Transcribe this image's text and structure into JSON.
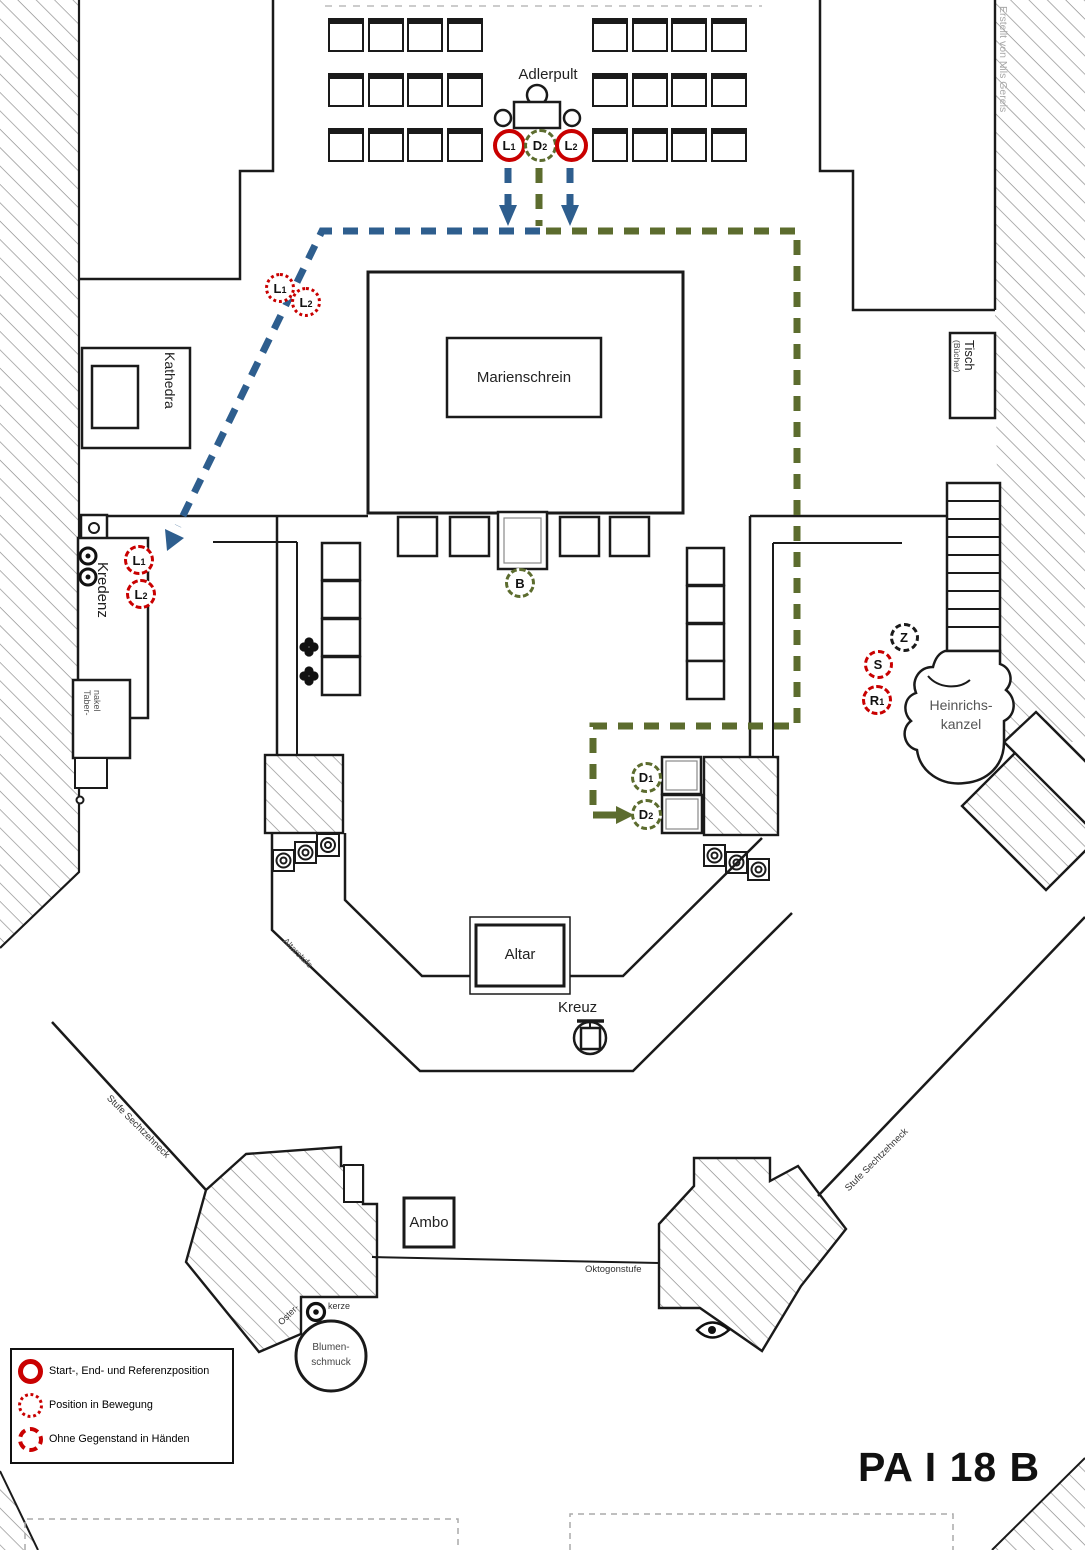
{
  "plan": {
    "code": "PA I 18 B",
    "credit": "Erstellt von Nils Gereis"
  },
  "colors": {
    "path_blue": "#2e5e8e",
    "path_green": "#5c6c2e",
    "marker_red": "#c90000",
    "marker_black": "#1a1a1a",
    "hatch_gray": "#8f8f8f",
    "credit_gray": "#a8a8a8"
  },
  "labels": {
    "adlerpult": "Adlerpult",
    "marienschrein": "Marienschrein",
    "kathedra": "Kathedra",
    "tisch": "Tisch",
    "tisch_sub": "(Bücher)",
    "kredenz": "Kredenz",
    "tabernakel_1": "Taber-",
    "tabernakel_2": "nakel",
    "heinrichskanzel_1": "Heinrichs-",
    "heinrichskanzel_2": "kanzel",
    "altar": "Altar",
    "kreuz": "Kreuz",
    "ambo": "Ambo",
    "blumenschmuck_1": "Blumen-",
    "blumenschmuck_2": "schmuck",
    "osterkerze_1": "Oster-",
    "osterkerze_2": "kerze",
    "altarstufe": "Altarstufe",
    "stufe_left": "Stufe Sechtzehneck",
    "stufe_right": "Stufe Sechtzehneck",
    "oktogonstufe": "Oktogonstufe"
  },
  "legend": {
    "items": [
      {
        "style": "solid",
        "label": "Start-, End- und Referenzposition"
      },
      {
        "style": "dotted",
        "label": "Position in Bewegung"
      },
      {
        "style": "dashed",
        "label": "Ohne Gegenstand in Händen"
      }
    ]
  },
  "markers": [
    {
      "id": "L1-start",
      "label": "L",
      "sub": "1",
      "style": "solid",
      "color": "red",
      "x": 509,
      "y": 145,
      "size": 33
    },
    {
      "id": "D2-start",
      "label": "D",
      "sub": "2",
      "style": "dashed",
      "color": "green",
      "x": 540,
      "y": 145,
      "size": 33
    },
    {
      "id": "L2-start",
      "label": "L",
      "sub": "2",
      "style": "solid",
      "color": "red",
      "x": 571,
      "y": 145,
      "size": 33
    },
    {
      "id": "L1-moving",
      "label": "L",
      "sub": "1",
      "style": "dotted",
      "color": "red",
      "x": 280,
      "y": 288,
      "size": 30
    },
    {
      "id": "L2-moving",
      "label": "L",
      "sub": "2",
      "style": "dotted",
      "color": "red",
      "x": 306,
      "y": 302,
      "size": 30
    },
    {
      "id": "L1-kredenz",
      "label": "L",
      "sub": "1",
      "style": "dashed",
      "color": "red",
      "x": 139,
      "y": 560,
      "size": 30
    },
    {
      "id": "L2-kredenz",
      "label": "L",
      "sub": "2",
      "style": "dashed",
      "color": "red",
      "x": 141,
      "y": 594,
      "size": 30
    },
    {
      "id": "B",
      "label": "B",
      "sub": "",
      "style": "dashed",
      "color": "green",
      "x": 520,
      "y": 583,
      "size": 30
    },
    {
      "id": "D1",
      "label": "D",
      "sub": "1",
      "style": "dashed",
      "color": "green",
      "x": 646,
      "y": 777,
      "size": 31
    },
    {
      "id": "D2-end",
      "label": "D",
      "sub": "2",
      "style": "dashed",
      "color": "green",
      "x": 646,
      "y": 814,
      "size": 31
    },
    {
      "id": "Z",
      "label": "Z",
      "sub": "",
      "style": "dashed",
      "color": "black",
      "x": 904,
      "y": 637,
      "size": 29
    },
    {
      "id": "S",
      "label": "S",
      "sub": "",
      "style": "dashed",
      "color": "red",
      "x": 878,
      "y": 664,
      "size": 29
    },
    {
      "id": "R1",
      "label": "R",
      "sub": "1",
      "style": "dashed",
      "color": "red",
      "x": 877,
      "y": 700,
      "size": 30
    }
  ],
  "seating": {
    "left": {
      "x": 328,
      "y": 18,
      "rows": 3,
      "cols": 4,
      "gx": 39.5,
      "gy": 55
    },
    "right": {
      "x": 592,
      "y": 18,
      "rows": 3,
      "cols": 4,
      "gx": 39.5,
      "gy": 55
    }
  }
}
